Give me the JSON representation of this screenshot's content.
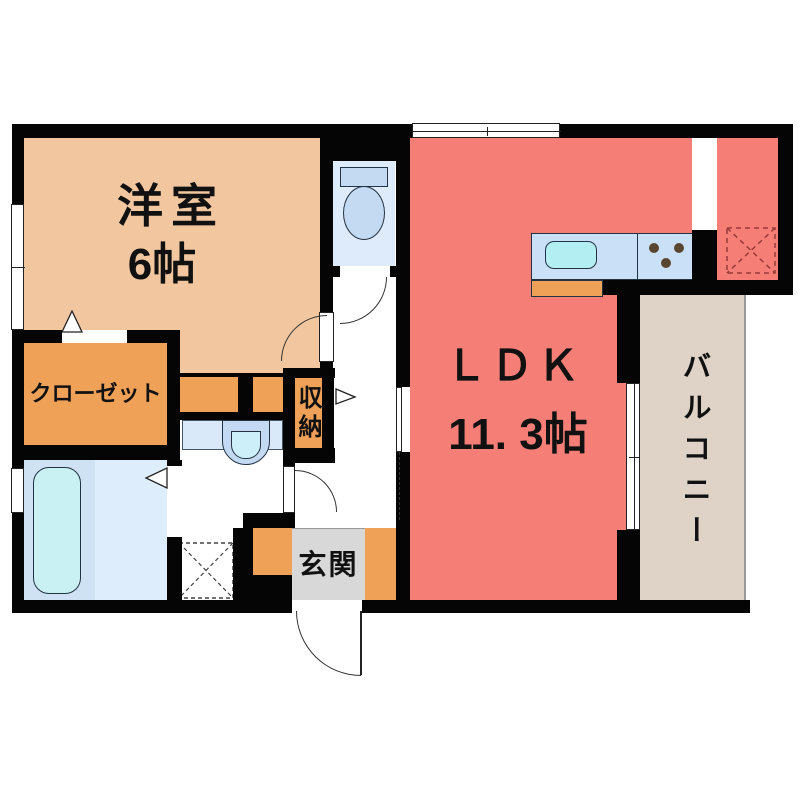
{
  "plan_title": "1LDK apartment floor plan",
  "rooms": {
    "western_room": {
      "name": "洋室",
      "size": "6帖"
    },
    "ldk": {
      "name": "ＬＤＫ",
      "size": "11. 3帖"
    },
    "closet": {
      "name": "クローゼット"
    },
    "storage": {
      "name": "収納"
    },
    "entrance": {
      "name": "玄関"
    },
    "balcony": {
      "name": "バルコニー"
    }
  },
  "fixtures": [
    "toilet",
    "bathtub",
    "washbasin",
    "kitchen-sink",
    "stove",
    "washing-machine-space",
    "refrigerator-space"
  ],
  "palette": {
    "wall": "#050505",
    "line": "#333333",
    "text": "#111111",
    "yoshitsu": "#f2c7a0",
    "orange": "#f0a158",
    "ldk": "#f57e77",
    "balcony": "#ded3c6",
    "genkan": "#d8d8d8",
    "toiletbg": "#ddebfa",
    "fixblue": "#c4daf3",
    "counter": "#c9e0f6",
    "sink": "#b2eef2",
    "tub": "#c9f1f3",
    "bathL": "#cfe2f3",
    "bathR": "#ddedfb",
    "vanity": "#d9e9f9",
    "bowl": "#cdeffa",
    "dot": "#5a4531",
    "fridgedash": "#993c36"
  }
}
